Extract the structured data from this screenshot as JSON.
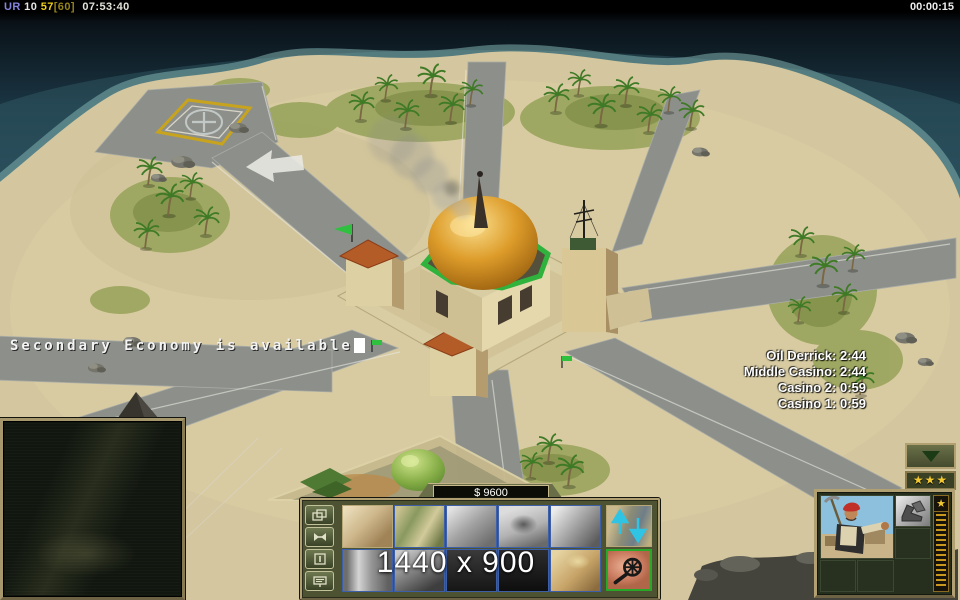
{
  "top_bar": {
    "perf_label": "UR",
    "perf_a": "10",
    "perf_b": "57",
    "perf_c": "[60]",
    "perf_time": "07:53:40",
    "clock": "00:00:15"
  },
  "hud": {
    "event_message": "Secondary Economy is available",
    "timers": [
      "Oil Derrick: 2:44",
      "Middle Casino: 2:44",
      "Casino 2: 0:59",
      "Casino 1: 0:59"
    ],
    "money": "$ 9600",
    "resolution_overlay": "1440 x 900",
    "rank_stars": "★★★",
    "exp_star": "★"
  },
  "colors": {
    "panel_tan": "#b1a172",
    "panel_olive": "#4d5233",
    "star_gold": "#f2c832",
    "flag_green": "#2fc040",
    "dome_gold": "#d89020",
    "arrow_cyan": "#30c4e4",
    "selection_green": "#28a828",
    "grid_border_blue": "#3c5fa8"
  },
  "icons": {
    "side_buttons": [
      "structures-icon",
      "wrench-icon",
      "door-pause-icon",
      "sell-sign-icon"
    ],
    "right_buttons": [
      "up-down-arrows-icon",
      "gear-wheel-icon"
    ],
    "upgrade_slot": "shoes-icon",
    "collapse": "triangle-down-icon"
  }
}
